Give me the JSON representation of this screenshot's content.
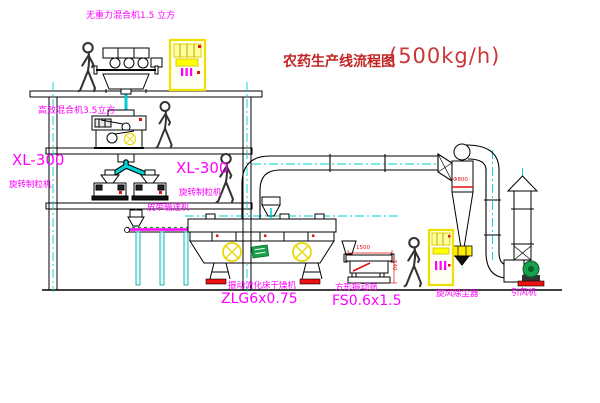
{
  "title": {
    "name": "农药生产线流程图",
    "capacity": "(500kg/h)"
  },
  "labels": {
    "top_mixer": "无重力混合机1.5 立方",
    "floor2_mixer": "高效混合机3.5立方",
    "granulator_left": {
      "model": "XL-300",
      "name": "旋转制粒机"
    },
    "granulator_mid": {
      "model": "XL-300",
      "name": "旋转制粒机"
    },
    "belt_conveyor": "皮带输送机",
    "dryer": {
      "name": "振动流化床干燥机",
      "model": "ZLG6x0.75"
    },
    "sieve": {
      "name": "方形振动筛",
      "model": "FS0.6x1.5"
    },
    "cyclone": "旋风除尘器",
    "fan": "引风机"
  },
  "dimensions": {
    "sieve_length": "1500",
    "sieve_height": "540",
    "cyclone_diameter": "Φ800"
  },
  "colors": {
    "label_magenta": "#ff00ff",
    "title_red": "#c22525",
    "centerline_cyan": "#00cfcf",
    "highlight_yellow": "#f2e400",
    "machine_green": "#18a04a",
    "accent_red": "#ee1111"
  }
}
